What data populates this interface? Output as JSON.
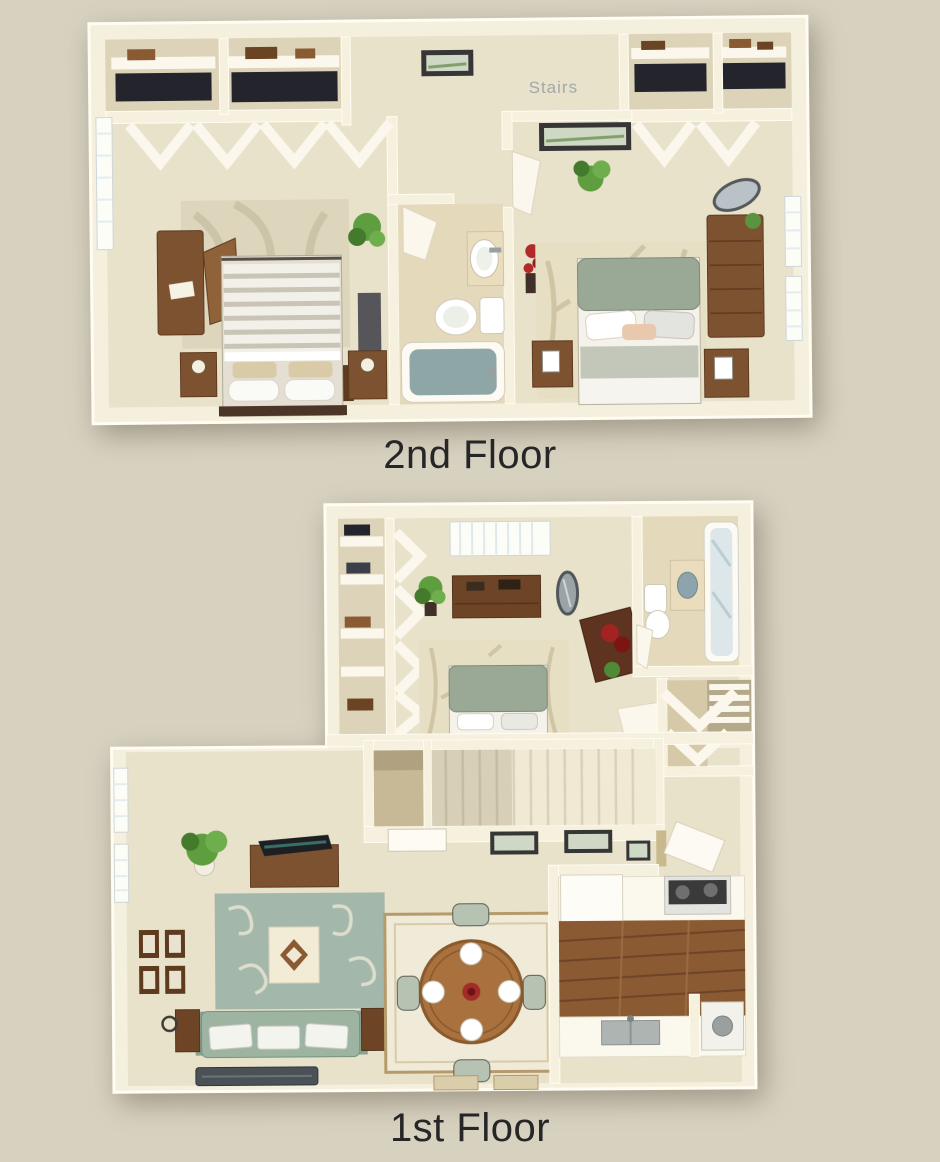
{
  "canvas": {
    "width": 940,
    "height": 1162,
    "background": "#d7d1c0"
  },
  "labels": {
    "second_floor": "2nd Floor",
    "first_floor": "1st Floor",
    "stairs": "Stairs"
  },
  "palette": {
    "background": "#d7d1c0",
    "wall": "#f6f0de",
    "wall_highlight": "#fffcf0",
    "carpet": "#e9e2cb",
    "bathroom_tile": "#e5d9bc",
    "closet_floor": "#ddd3b8",
    "wood": "#7d5230",
    "wood_dark": "#5e3a1f",
    "kitchen_wood": "#8a5a33",
    "sage_green": "#9db4a3",
    "teal_rug": "#a3b8ab",
    "tub_water": "#8ea6a5",
    "plant_green": "#5f9e3f",
    "accent_red": "#a32c28",
    "label_text": "#262626",
    "stairs_watermark": "#8e999f"
  },
  "floors": [
    {
      "label": "2nd Floor",
      "rooms": [
        {
          "name": "bedroom-1",
          "furniture": [
            "striped-double-bed",
            "two-nightstands-with-lamps",
            "armoire-with-open-door",
            "plants",
            "leaf-rug",
            "window",
            "double-closet-with-bifold-doors",
            "gray-cabinet",
            "chest"
          ]
        },
        {
          "name": "stairs-landing-hall",
          "furniture": [
            "framed-picture"
          ],
          "watermark": "Stairs"
        },
        {
          "name": "bathroom",
          "furniture": [
            "bathtub",
            "toilet",
            "vanity-sink",
            "door"
          ]
        },
        {
          "name": "bedroom-2",
          "furniture": [
            "sage-headboard-bed",
            "two-nightstands",
            "tall-dresser",
            "oval-mirror",
            "plant",
            "red-flowers",
            "framed-picture",
            "bamboo-rug",
            "double-closet-with-bifold-doors",
            "windows"
          ]
        }
      ]
    },
    {
      "label": "1st Floor",
      "rooms": [
        {
          "name": "bedroom-3",
          "furniture": [
            "gray-headboard-bed",
            "bamboo-rug",
            "dresser",
            "oval-mirror",
            "tall-plant",
            "vanity-with-red-garment",
            "shelved-closet-with-bifold-doors",
            "window-with-blinds"
          ]
        },
        {
          "name": "bathroom",
          "furniture": [
            "shower-tub",
            "toilet",
            "vanity-sink",
            "linen-shelves",
            "closet-with-bifold-door"
          ]
        },
        {
          "name": "staircase",
          "furniture": [
            "under-stair-closet",
            "white-door",
            "two-framed-pictures"
          ]
        },
        {
          "name": "living-room",
          "furniture": [
            "sage-sofa-with-white-cushions",
            "two-end-tables-with-lamps",
            "coffee-table",
            "swirl-teal-rug",
            "tv-console-with-tv",
            "corner-plant",
            "four-wall-frames",
            "windows",
            "dark-doormat"
          ]
        },
        {
          "name": "dining-area",
          "furniture": [
            "round-wood-table",
            "four-place-settings",
            "red-centerpiece",
            "four-chairs",
            "bordered-rug",
            "two-floor-mats"
          ]
        },
        {
          "name": "kitchen",
          "furniture": [
            "refrigerator",
            "stove-with-burners",
            "sink-counter",
            "plank-wood-floor",
            "utility-closet-with-washer"
          ]
        },
        {
          "name": "entry",
          "furniture": [
            "front-door",
            "framed-picture"
          ]
        }
      ]
    }
  ]
}
